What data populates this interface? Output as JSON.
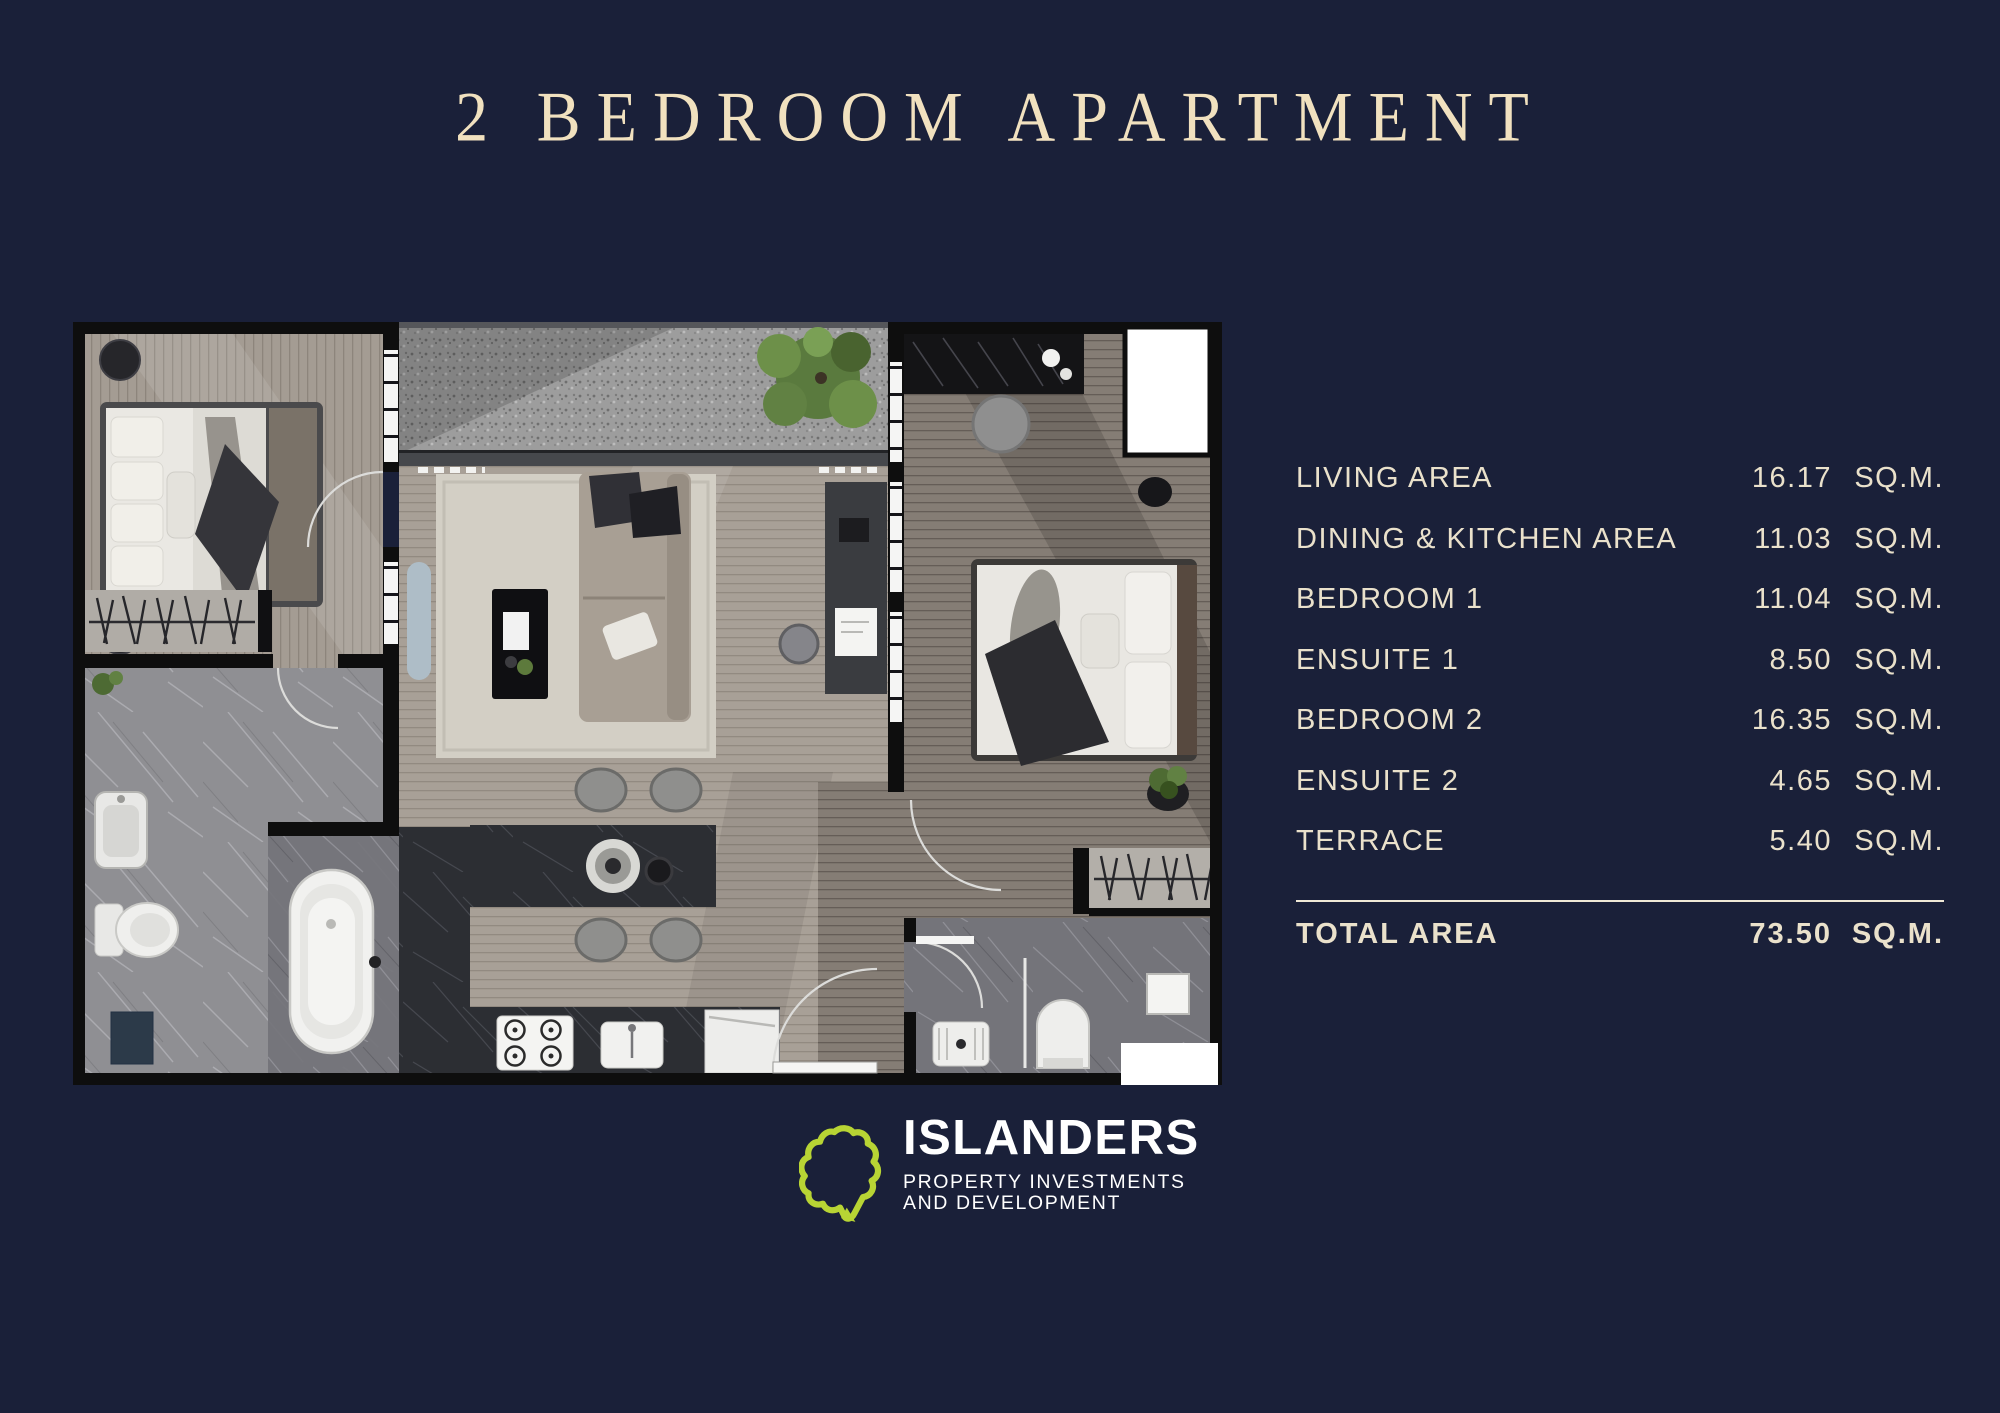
{
  "title": "2 BEDROOM APARTMENT",
  "area_table": {
    "rows": [
      {
        "label": "LIVING AREA",
        "value": "16.17",
        "unit": "SQ.M."
      },
      {
        "label": "DINING & KITCHEN AREA",
        "value": "11.03",
        "unit": "SQ.M."
      },
      {
        "label": "BEDROOM 1",
        "value": "11.04",
        "unit": "SQ.M."
      },
      {
        "label": "ENSUITE 1",
        "value": "8.50",
        "unit": "SQ.M."
      },
      {
        "label": "BEDROOM 2",
        "value": "16.35",
        "unit": "SQ.M."
      },
      {
        "label": "ENSUITE 2",
        "value": "4.65",
        "unit": "SQ.M."
      },
      {
        "label": "TERRACE",
        "value": "5.40",
        "unit": "SQ.M."
      }
    ],
    "total": {
      "label": "TOTAL AREA",
      "value": "73.50",
      "unit": "SQ.M."
    }
  },
  "logo": {
    "name": "ISLANDERS",
    "tagline_line1": "PROPERTY INVESTMENTS",
    "tagline_line2": "AND DEVELOPMENT",
    "icon": "island-outline-icon",
    "icon_color": "#b8d434"
  },
  "colors": {
    "background": "#1a2039",
    "title_text": "#f1e1bf",
    "table_text": "#eae1cb",
    "divider": "#efe8d6",
    "logo_text": "#ffffff",
    "logo_green": "#b8d434"
  }
}
